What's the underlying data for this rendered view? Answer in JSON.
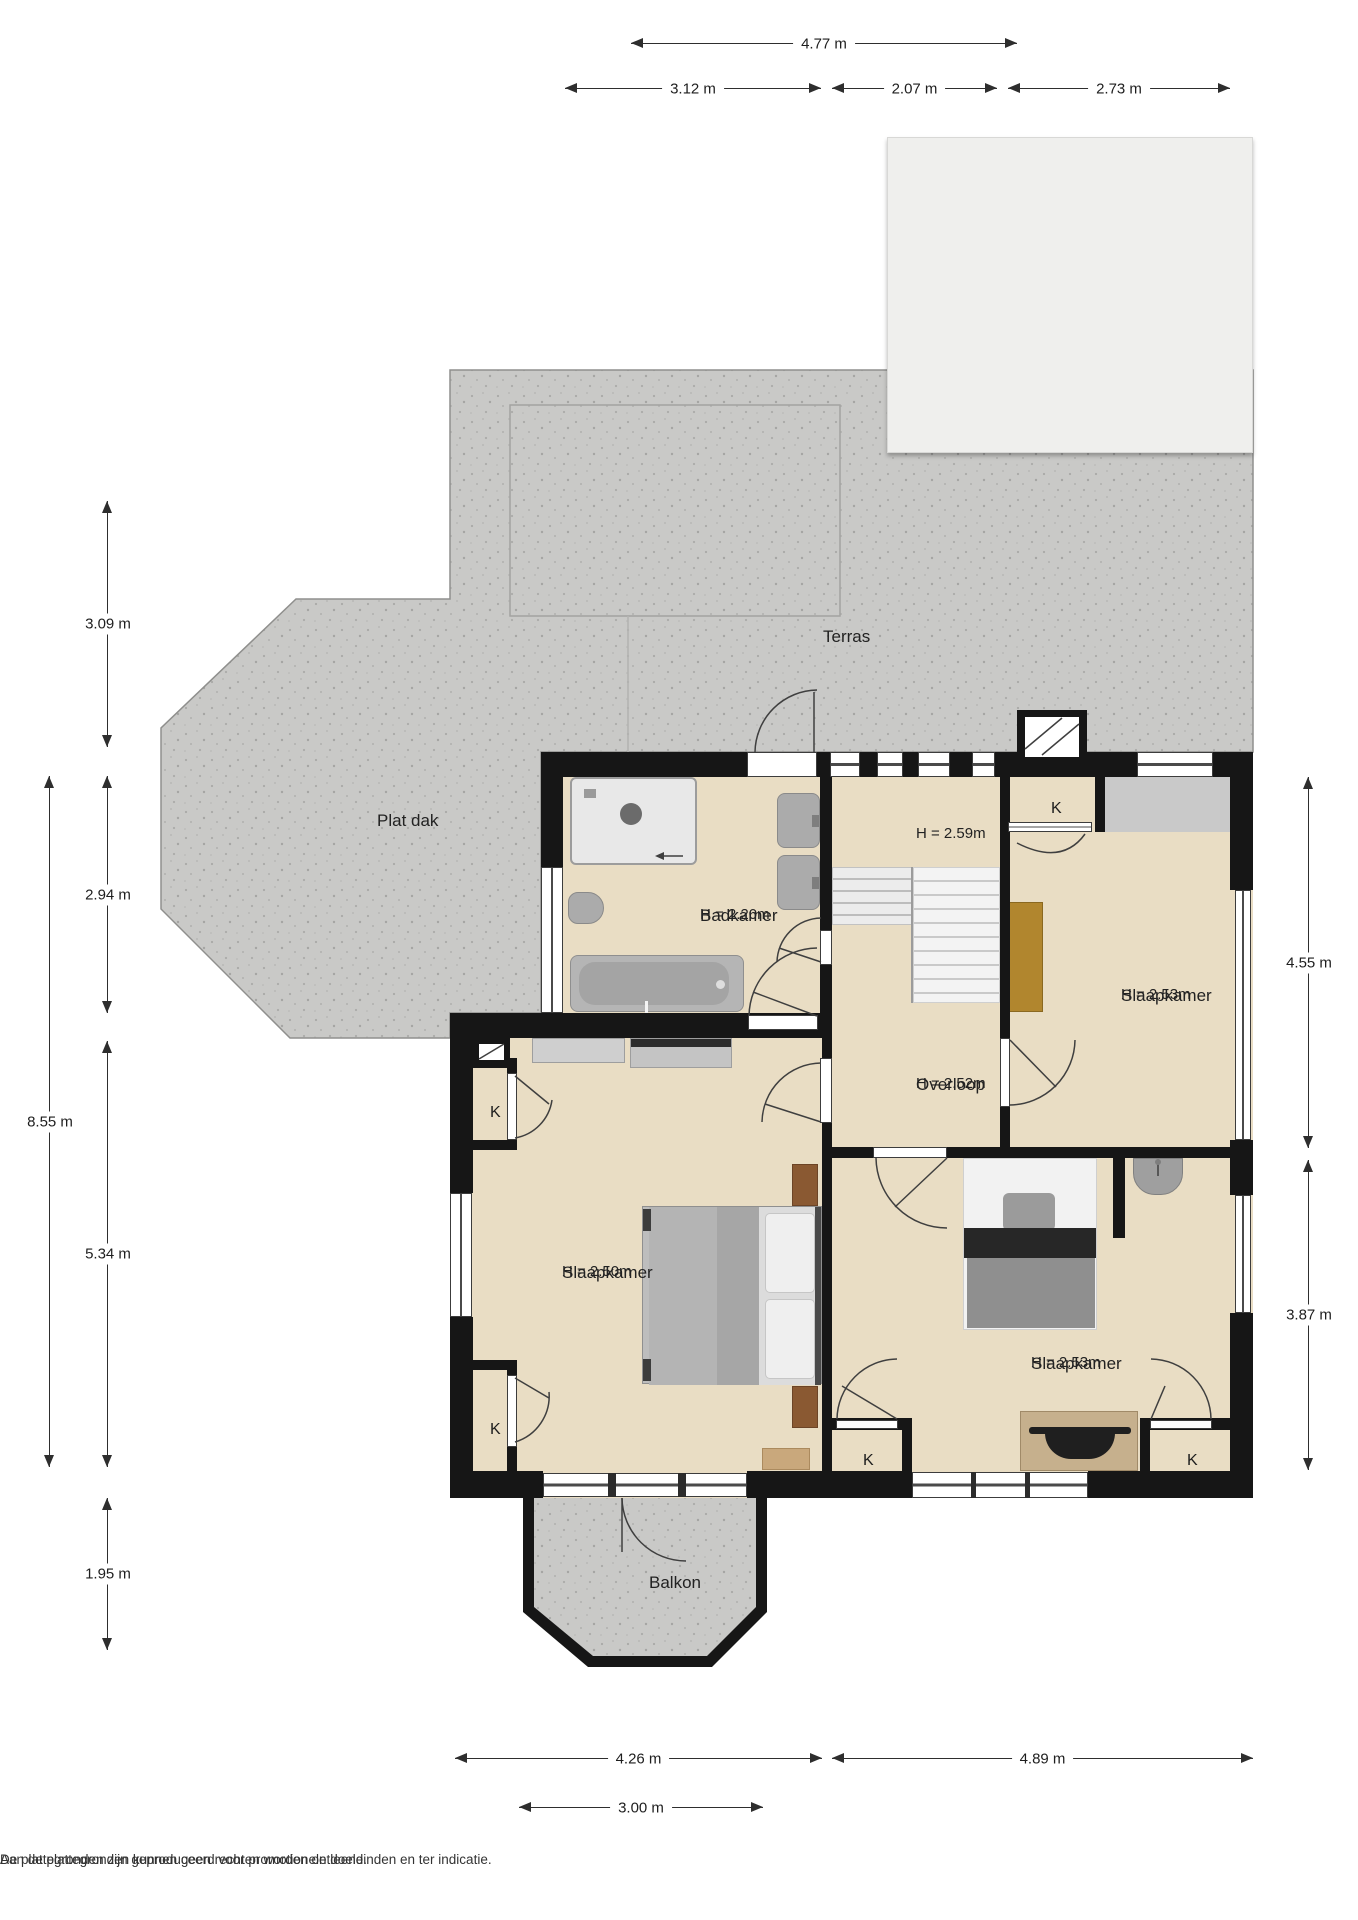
{
  "meta": {
    "type": "floorplan",
    "language": "nl"
  },
  "colors": {
    "wall": "#161616",
    "floor": "#e9ddc4",
    "concrete": "#c9c9c7",
    "canopy_pane": "#c7c7c5",
    "accent_wood": "#b1862e"
  },
  "rooms": {
    "terras": {
      "name": "Terras"
    },
    "plat_dak": {
      "name": "Plat dak"
    },
    "badkamer": {
      "name": "Badkamer",
      "height": "H = 2.20m"
    },
    "landing_top": {
      "height": "H = 2.59m"
    },
    "overloop": {
      "name": "Overloop",
      "height": "H = 2.52m"
    },
    "slaapkamer_rechtsboven": {
      "name": "Slaapkamer",
      "height": "H = 2.53m"
    },
    "slaapkamer_linksonder": {
      "name": "Slaapkamer",
      "height": "H = 2.50m"
    },
    "slaapkamer_rechtsonder": {
      "name": "Slaapkamer",
      "height": "H = 2.53m"
    },
    "balkon": {
      "name": "Balkon"
    }
  },
  "closets": {
    "label_rechtsboven": "K",
    "label_linksboven": "K",
    "label_linksonder": "K",
    "label_onder_links": "K",
    "label_onder_rechts": "K"
  },
  "dimensions": {
    "top": {
      "d477": "4.77 m",
      "d312": "3.12 m",
      "d207": "2.07 m",
      "d273": "2.73 m"
    },
    "left": {
      "d309": "3.09 m",
      "d294": "2.94 m",
      "d855": "8.55 m",
      "d534": "5.34 m",
      "d195": "1.95 m"
    },
    "right": {
      "d455": "4.55 m",
      "d387": "3.87 m"
    },
    "bottom": {
      "d426": "4.26 m",
      "d489": "4.89 m",
      "d300": "3.00 m"
    }
  },
  "footer": {
    "line1": "De plattegronden zijn geproduceerd voor promotionele doeleinden en ter indicatie.",
    "line2": "Aan de plattegronden kunnen geen rechten worden ontleend."
  }
}
